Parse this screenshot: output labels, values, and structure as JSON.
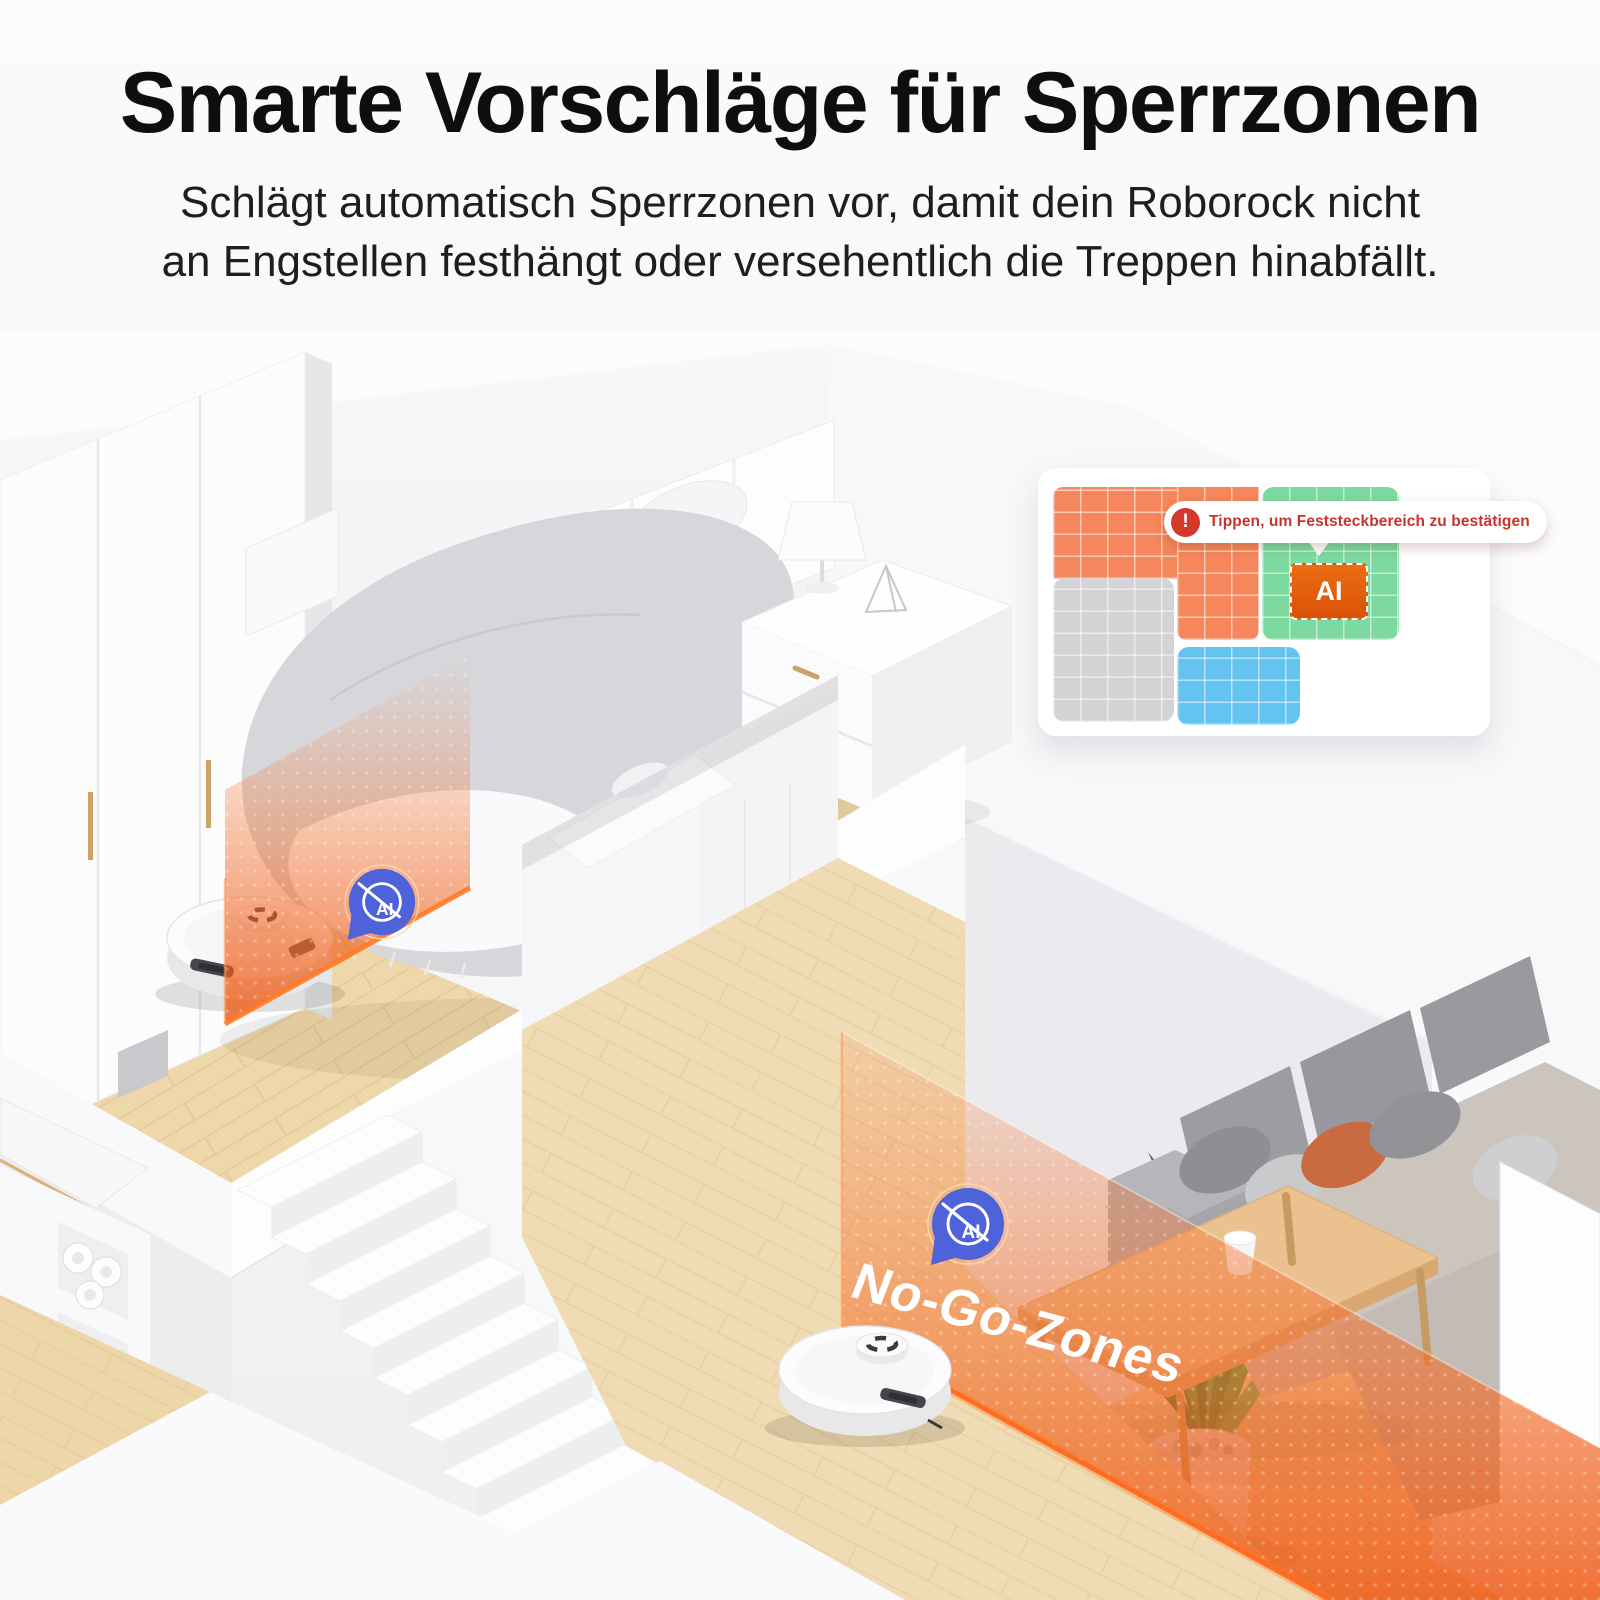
{
  "page": {
    "background_color": "#F5F5F6"
  },
  "header": {
    "title": "Smarte Vorschläge für Sperrzonen",
    "subtitle_line1": "Schlägt automatisch Sperrzonen vor, damit dein Roborock nicht",
    "subtitle_line2": "an Engstellen festhängt oder versehentlich die Treppen hinabfällt."
  },
  "map_card": {
    "tooltip": {
      "alert_icon_glyph": "!",
      "text": "Tippen, um Feststeckbereich zu bestätigen",
      "text_color": "#C8332B",
      "alert_color": "#D4382C"
    },
    "ai_zone_label": "AI",
    "ai_zone_color": "#DE5A12",
    "zones": [
      {
        "name": "stuck-area-room",
        "color": "#F6875C"
      },
      {
        "name": "suggested-zone-room",
        "color": "#7CD9A0"
      },
      {
        "name": "mapped-room",
        "color": "#D4D4D7"
      },
      {
        "name": "water-area-room",
        "color": "#63C4F2"
      }
    ]
  },
  "scene": {
    "no_go_zone_label": "No-Go-Zones",
    "ai_badge_label": "AI",
    "zone_overlay_color": "#F3702E",
    "zone_edge_glow_color": "#FF7A26",
    "ai_badge_color": "#4E63DA"
  }
}
